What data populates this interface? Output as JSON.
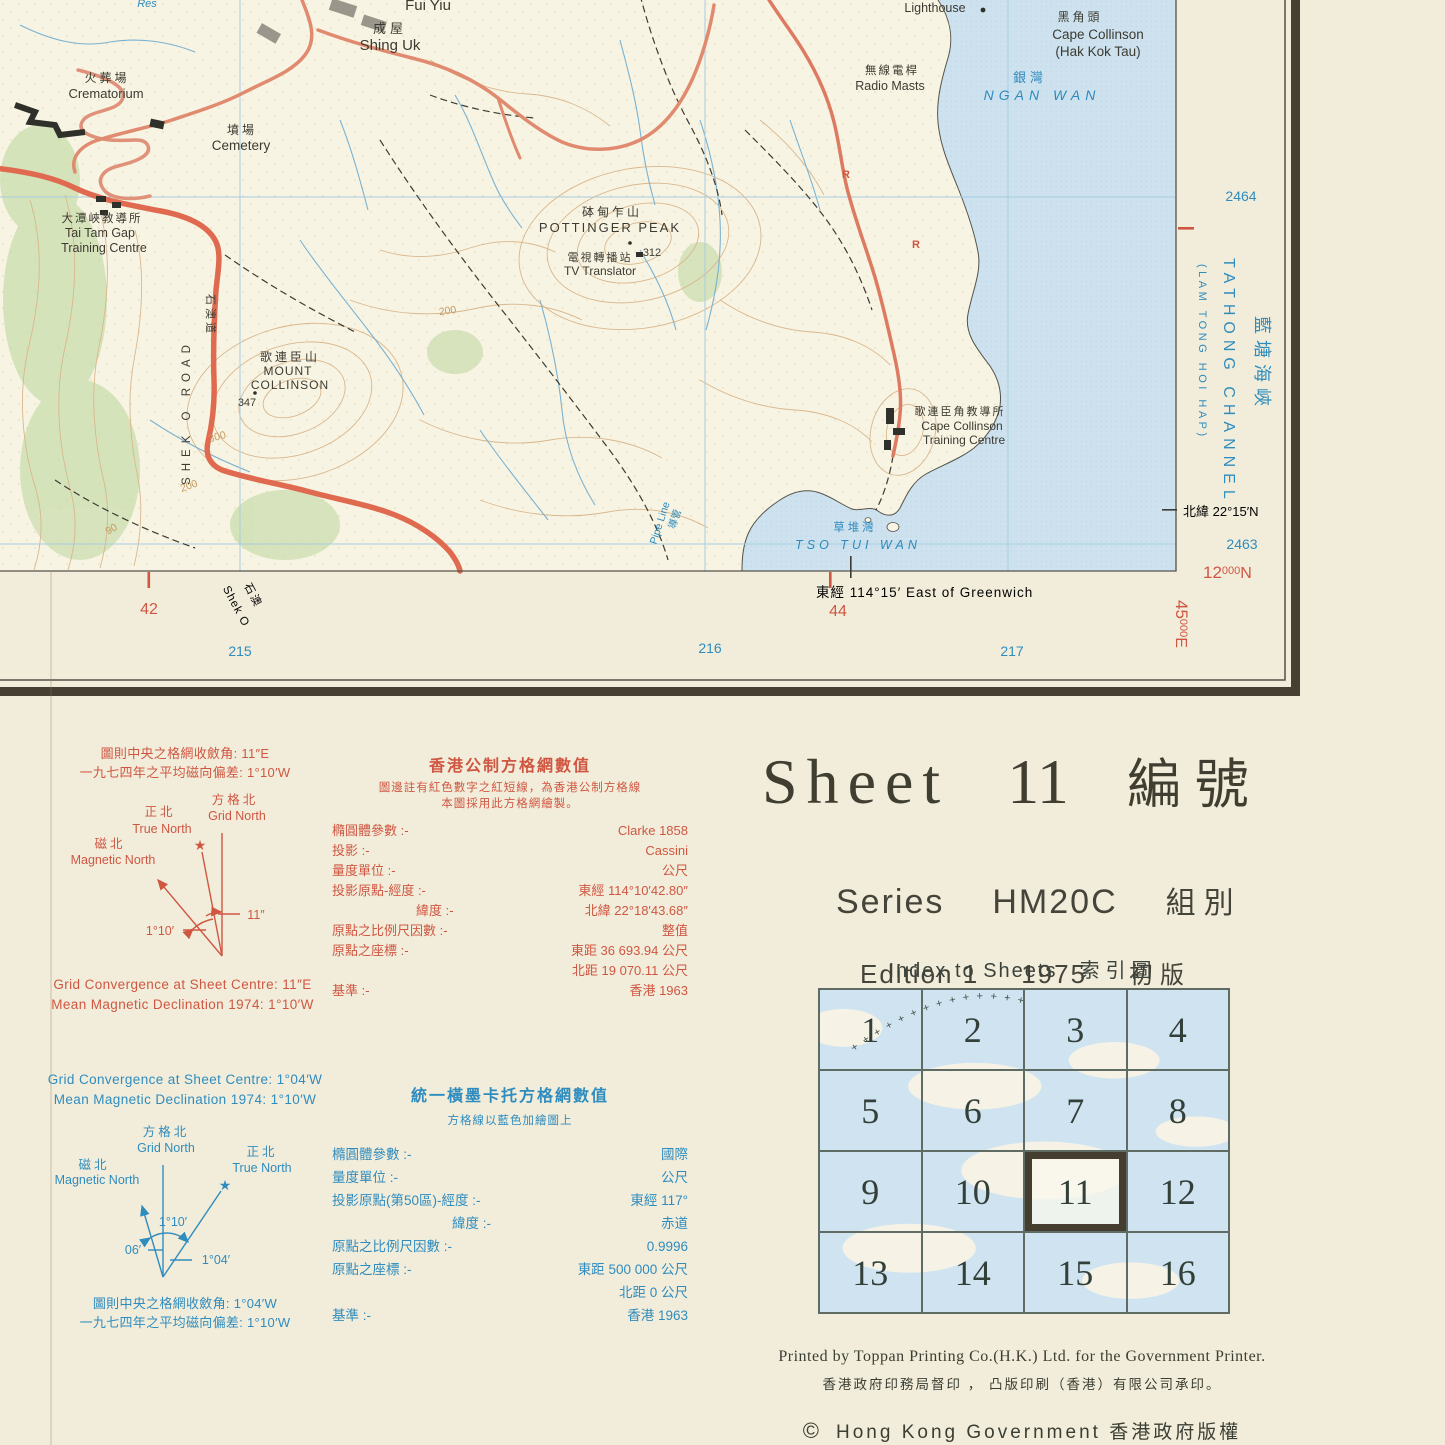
{
  "map": {
    "labels": {
      "res": "Res",
      "fui_yiu": "Fui Yiu",
      "shing_uk_cjk": "成屋",
      "shing_uk_en": "Shing Uk",
      "crematorium_cjk": "火葬場",
      "crematorium_en": "Crematorium",
      "cemetery_cjk": "墳場",
      "cemetery_en": "Cemetery",
      "tai_tam_gap_cjk": "大潭峽教導所",
      "tai_tam_gap_en1": "Tai Tam Gap",
      "tai_tam_gap_en2": "Training Centre",
      "pottinger_cjk": "砵甸乍山",
      "pottinger_en": "POTTINGER PEAK",
      "pottinger_elev": "312",
      "tv_cjk": "電視轉播站",
      "tv_en": "TV Translator",
      "collinson_cjk": "歌連臣山",
      "collinson_en1": "MOUNT",
      "collinson_en2": "COLLINSON",
      "collinson_elev": "347",
      "lighthouse": "Lighthouse",
      "cape_cjk": "黑角頭",
      "cape_en1": "Cape Collinson",
      "cape_en2": "(Hak Kok Tau)",
      "radio_cjk": "無線電桿",
      "radio_en": "Radio Masts",
      "ngan_cjk": "銀灣",
      "ngan_en": "NGAN WAN",
      "cct_cjk": "歌連臣角教導所",
      "cct_en1": "Cape Collinson",
      "cct_en2": "Training Centre",
      "tso_cjk": "草堆灣",
      "tso_en": "TSO TUI WAN",
      "pipe_en": "Pipe Line",
      "pipe_cjk": "導管",
      "shek_o_road_en": "SHEK O ROAD",
      "shek_o_road_cjk": "石澳道",
      "route_r": "R",
      "contour_300": "300",
      "contour_200": "200",
      "contour_90": "90"
    },
    "margin": {
      "grid_42": "42",
      "grid_44": "44",
      "utm_215": "215",
      "utm_216": "216",
      "utm_217": "217",
      "utm_2464": "2464",
      "utm_2463": "2463",
      "northing_main": "12",
      "northing_small": "000",
      "northing_unit": "N",
      "easting_main": "45",
      "easting_small": "000",
      "easting_unit": "E",
      "latitude": "北緯 22°15′N",
      "longitude": "東經 114°15′ East of Greenwich",
      "shek_o_cjk": "石澳",
      "shek_o_en": "Shek O",
      "channel_en": "TATHONG CHANNEL",
      "channel_alt": "(LAM TONG HOI HAP)",
      "channel_cjk": "藍塘海峽"
    }
  },
  "declination_hk": {
    "cjk_line1": "圖則中央之格網收斂角: 11″E",
    "cjk_line2": "一九七四年之平均磁向偏差: 1°10′W",
    "grid_north_cjk": "方格北",
    "grid_north_en": "Grid North",
    "true_north_cjk": "正北",
    "true_north_en": "True North",
    "magnetic_north_cjk": "磁北",
    "magnetic_north_en": "Magnetic North",
    "angle_convergence": "11″",
    "angle_declination": "1°10′",
    "en_line1": "Grid Convergence at Sheet Centre: 11″E",
    "en_line2": "Mean Magnetic Declination 1974: 1°10′W"
  },
  "hk_grid": {
    "title": "香港公制方格網數值",
    "sub1": "圖邊註有紅色數字之紅短線，為香港公制方格線",
    "sub2": "本圖採用此方格網繪製。",
    "rows": [
      {
        "label": "橢圓體參數 :-",
        "value": "Clarke 1858"
      },
      {
        "label": "投影 :-",
        "value": "Cassini"
      },
      {
        "label": "量度單位 :-",
        "value": "公尺"
      },
      {
        "label": "投影原點-經度 :-",
        "value": "東經 114°10′42.80″"
      },
      {
        "label": "緯度 :-",
        "value": "北緯 22°18′43.68″"
      },
      {
        "label": "原點之比例尺因數 :-",
        "value": "整值"
      },
      {
        "label": "原點之座標 :-",
        "value": "東距 36 693.94 公尺"
      },
      {
        "label": "",
        "value": "北距 19 070.11 公尺"
      },
      {
        "label": "基準 :-",
        "value": "香港 1963"
      }
    ]
  },
  "declination_utm": {
    "en_line1": "Grid Convergence at Sheet Centre: 1°04′W",
    "en_line2": "Mean Magnetic Declination 1974: 1°10′W",
    "grid_north_cjk": "方格北",
    "grid_north_en": "Grid North",
    "true_north_cjk": "正北",
    "true_north_en": "True North",
    "magnetic_north_cjk": "磁北",
    "magnetic_north_en": "Magnetic North",
    "angle_declination": "1°10′",
    "angle_magnetic": "06′",
    "angle_convergence": "1°04′",
    "cjk_line1": "圖則中央之格網收斂角: 1°04′W",
    "cjk_line2": "一九七四年之平均磁向偏差: 1°10′W"
  },
  "utm_grid": {
    "title": "統一橫墨卡托方格網數值",
    "sub": "方格線以藍色加繪圖上",
    "rows": [
      {
        "label": "橢圓體參數 :-",
        "value": "國際"
      },
      {
        "label": "量度單位 :-",
        "value": "公尺"
      },
      {
        "label": "投影原點(第50區)-經度 :-",
        "value": "東經 117°"
      },
      {
        "label": "緯度 :-",
        "value": "赤道"
      },
      {
        "label": "原點之比例尺因數 :-",
        "value": "0.9996"
      },
      {
        "label": "原點之座標 :-",
        "value": "東距 500 000 公尺"
      },
      {
        "label": "",
        "value": "北距 0 公尺"
      },
      {
        "label": "基準 :-",
        "value": "香港 1963"
      }
    ]
  },
  "title_block": {
    "sheet_label": "Sheet",
    "sheet_number": "11",
    "sheet_cjk": "編號",
    "series_label": "Series",
    "series_code": "HM20C",
    "series_cjk": "組別",
    "edition_label": "Edition 1",
    "edition_year": "1975",
    "edition_cjk": "初版"
  },
  "index": {
    "heading_en": "Index to Sheets",
    "heading_cjk": "索引圖",
    "cells": [
      "1",
      "2",
      "3",
      "4",
      "5",
      "6",
      "7",
      "8",
      "9",
      "10",
      "11",
      "12",
      "13",
      "14",
      "15",
      "16"
    ],
    "current_sheet": "11",
    "track": "+ + + + + + + + + + + + + +"
  },
  "imprint": {
    "printed_en": "Printed by Toppan Printing Co.(H.K.) Ltd. for the Government Printer.",
    "printed_cjk": "香港政府印務局督印 ， 凸版印刷（香港）有限公司承印。",
    "copyright_mark": "©",
    "copyright_text": "Hong Kong Government 香港政府版權"
  },
  "colors": {
    "margin_red": "#cf5742",
    "margin_blue": "#2f8cbf",
    "sea": "#cde2ee",
    "land": "#f8f4e3",
    "road_major": "#e06a50",
    "contour": "#d9b78d",
    "border_dark": "#474032"
  }
}
